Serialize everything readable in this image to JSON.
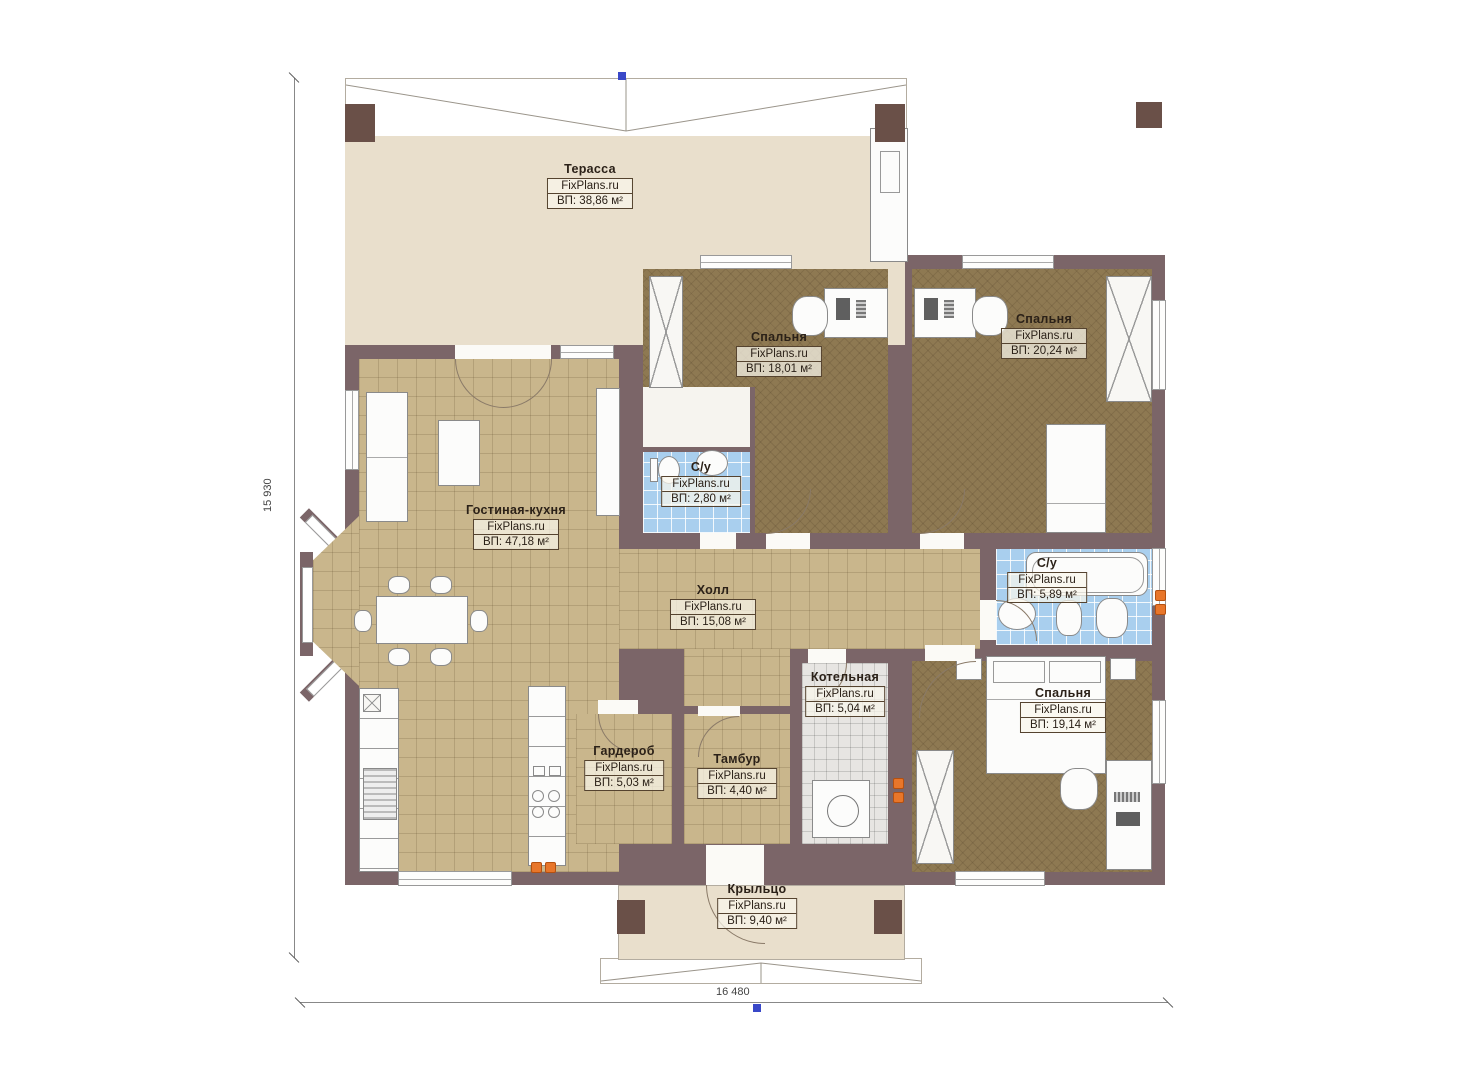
{
  "plan": {
    "brand": "FixPlans.ru",
    "rooms": [
      {
        "name": "Терасса",
        "area": "ВП: 38,86 м²"
      },
      {
        "name": "Гостиная-кухня",
        "area": "ВП: 47,18 м²"
      },
      {
        "name": "Спальня",
        "area": "ВП: 18,01 м²"
      },
      {
        "name": "Спальня",
        "area": "ВП: 20,24 м²"
      },
      {
        "name": "С/у",
        "area": "ВП: 2,80 м²"
      },
      {
        "name": "Холл",
        "area": "ВП: 15,08 м²"
      },
      {
        "name": "С/у",
        "area": "ВП: 5,89 м²"
      },
      {
        "name": "Котельная",
        "area": "ВП: 5,04 м²"
      },
      {
        "name": "Гардероб",
        "area": "ВП: 5,03 м²"
      },
      {
        "name": "Тамбур",
        "area": "ВП: 4,40 м²"
      },
      {
        "name": "Спальня",
        "area": "ВП: 19,14 м²"
      },
      {
        "name": "Крыльцо",
        "area": "ВП: 9,40 м²"
      }
    ],
    "dimensions": {
      "left": "15 930",
      "bottom": "16 480"
    },
    "colors": {
      "wall": "#7b6568",
      "tile_floor": "#c9b68c",
      "carpet": "#8e7952",
      "bath_tile": "#a9cfee",
      "terrace_floor": "#e9dfcc",
      "boiler_tile": "#e7e5e2",
      "outlet": "#e8762a",
      "marker": "#3948c8"
    }
  }
}
